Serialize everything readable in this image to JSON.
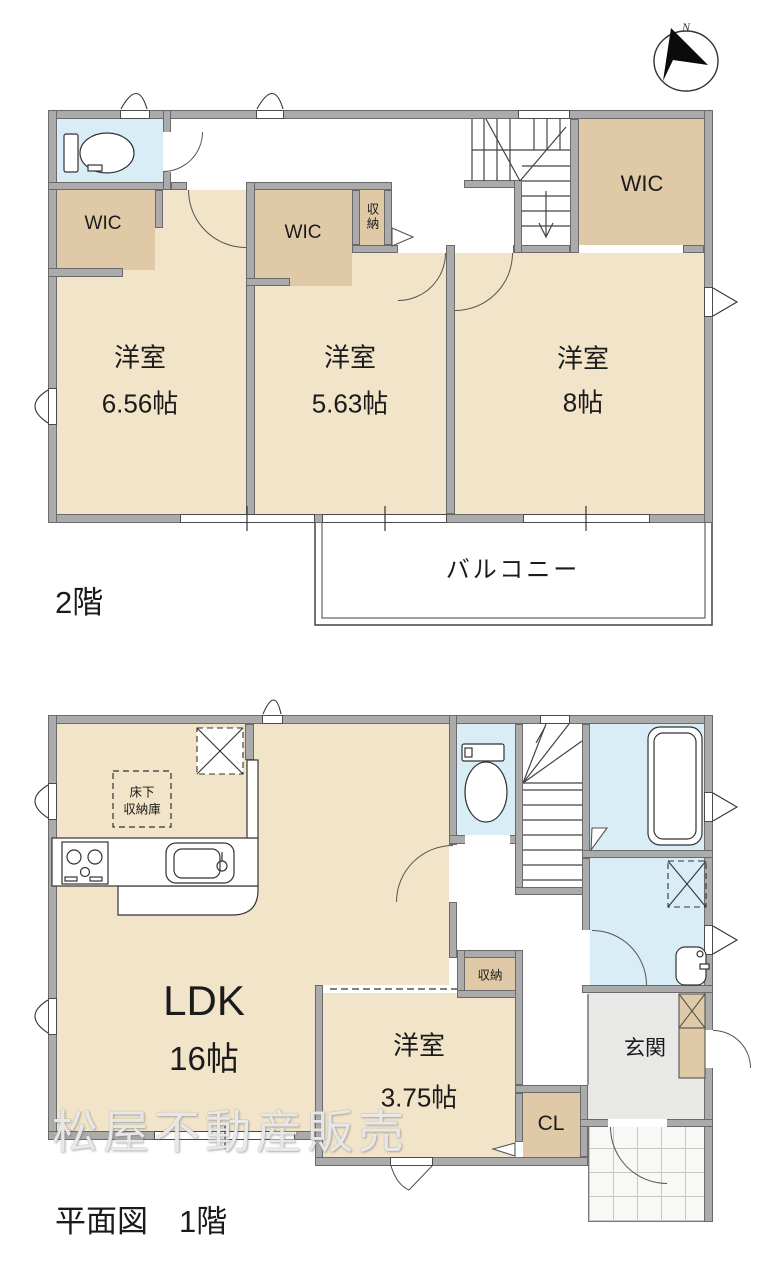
{
  "compass": {
    "label": "N"
  },
  "floor2": {
    "label": "2階",
    "bed1": {
      "name": "洋室",
      "size": "6.56帖"
    },
    "bed2": {
      "name": "洋室",
      "size": "5.63帖"
    },
    "bed3": {
      "name": "洋室",
      "size": "8帖"
    },
    "wic_left": "WIC",
    "wic_mid": "WIC",
    "wic_right": "WIC",
    "closet": "収納",
    "balcony": "バルコニー"
  },
  "floor1": {
    "label": "平面図　1階",
    "ldk": {
      "name": "LDK",
      "size": "16帖"
    },
    "bed": {
      "name": "洋室",
      "size": "3.75帖"
    },
    "closet": "収納",
    "cl": "CL",
    "genkan": "玄関",
    "underfloor1": "床下",
    "underfloor2": "収納庫"
  },
  "watermark": "松屋不動産販売",
  "colors": {
    "room": "#f2e4c9",
    "closet": "#dfc9a6",
    "wet": "#d9edf7",
    "wall": "#ababab",
    "genkan": "#e8e8e6"
  }
}
